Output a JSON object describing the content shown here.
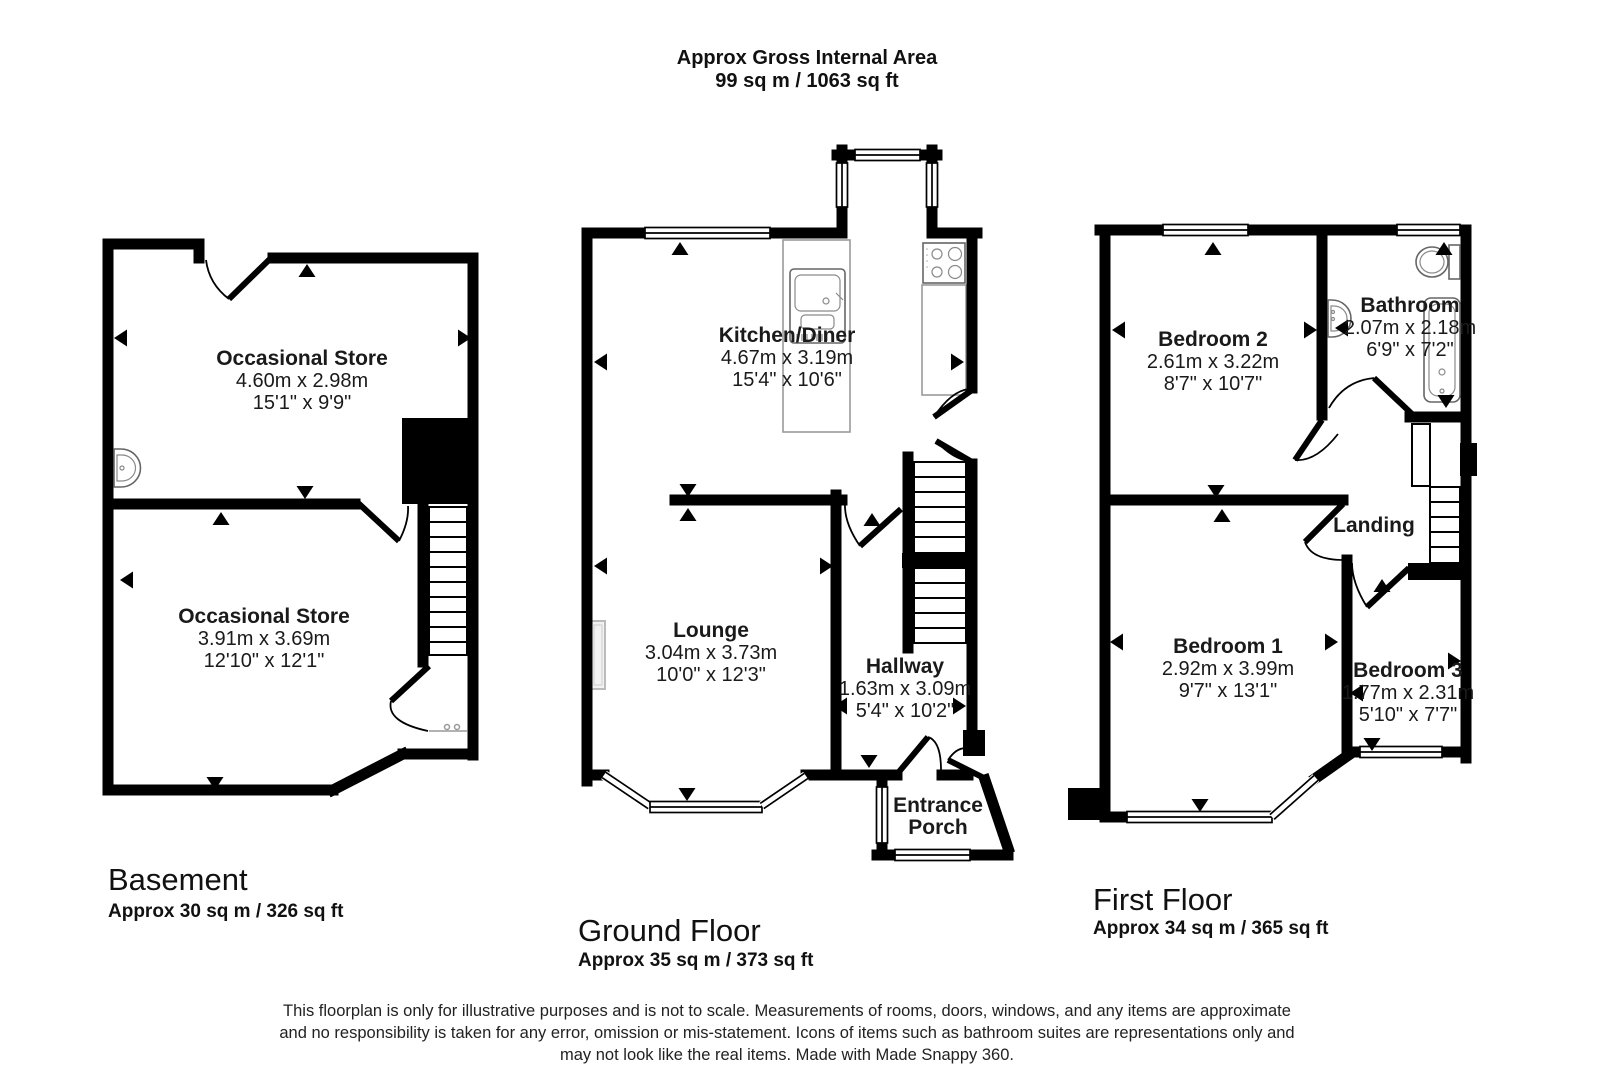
{
  "header": {
    "title": "Approx Gross Internal Area",
    "subtitle": "99 sq m / 1063 sq ft"
  },
  "basement": {
    "label": "Basement",
    "area": "Approx 30 sq m / 326 sq ft",
    "store_upper": {
      "name": "Occasional Store",
      "metric": "4.60m x 2.98m",
      "imperial": "15'1\" x 9'9\""
    },
    "store_lower": {
      "name": "Occasional Store",
      "metric": "3.91m x 3.69m",
      "imperial": "12'10\" x 12'1\""
    }
  },
  "ground_floor": {
    "label": "Ground Floor",
    "area": "Approx 35 sq m / 373 sq ft",
    "kitchen_diner": {
      "name": "Kitchen/Diner",
      "metric": "4.67m x 3.19m",
      "imperial": "15'4\" x 10'6\""
    },
    "lounge": {
      "name": "Lounge",
      "metric": "3.04m x 3.73m",
      "imperial": "10'0\" x 12'3\""
    },
    "hallway": {
      "name": "Hallway",
      "metric": "1.63m x 3.09m",
      "imperial": "5'4\" x 10'2\""
    },
    "entrance_porch": {
      "name_line1": "Entrance",
      "name_line2": "Porch"
    }
  },
  "first_floor": {
    "label": "First Floor",
    "area": "Approx 34 sq m / 365 sq ft",
    "bedroom2": {
      "name": "Bedroom 2",
      "metric": "2.61m x 3.22m",
      "imperial": "8'7\" x 10'7\""
    },
    "bathroom": {
      "name": "Bathroom",
      "metric": "2.07m x 2.18m",
      "imperial": "6'9\" x 7'2\""
    },
    "landing": {
      "name": "Landing"
    },
    "bedroom1": {
      "name": "Bedroom 1",
      "metric": "2.92m x 3.99m",
      "imperial": "9'7\" x 13'1\""
    },
    "bedroom3": {
      "name": "Bedroom 3",
      "metric": "1.77m x 2.31m",
      "imperial": "5'10\" x 7'7\""
    }
  },
  "footer": {
    "line1": "This floorplan is only for illustrative purposes and is not to scale. Measurements of rooms, doors, windows, and any items are approximate",
    "line2": "and no responsibility is taken for any error, omission or mis-statement. Icons of items such as bathroom suites are representations only and",
    "line3": "may not look like the real items. Made with Made Snappy 360."
  }
}
